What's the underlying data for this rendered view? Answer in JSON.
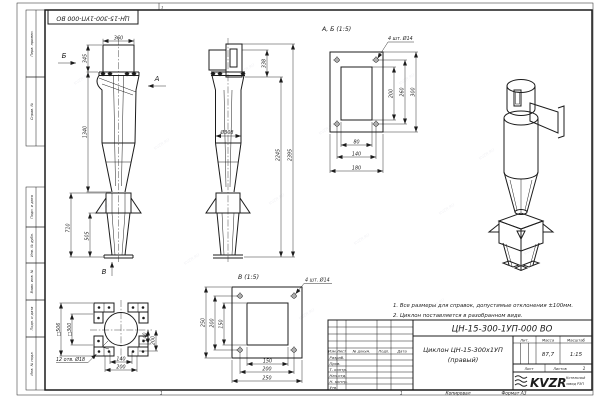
{
  "frame": {
    "stamp": "ЦН-15-300-1УП-000 ВО",
    "side_labels": [
      "Перв. примен.",
      "Справ. №",
      "Подп. и дата",
      "Инв. № дубл.",
      "Взам. инв. №",
      "Подп. и дата",
      "Инв. № подл."
    ],
    "fold_mark": "1",
    "bottom_mark": "1",
    "copied": "Копировал",
    "format": "Формат А3"
  },
  "watermark": {
    "text": "KVZR.RU"
  },
  "notes": {
    "line1": "1. Все размеры для справок, допустимые отклонения ±100мм.",
    "line2": "2. Циклон поставляется в разобранном виде."
  },
  "views": {
    "front": {
      "d360": "360",
      "d345": "345",
      "d1340": "1340",
      "d710": "710",
      "d505": "505",
      "arrow_a": "А",
      "arrow_b": "Б",
      "arrow_v": "В"
    },
    "side": {
      "d338": "338",
      "d308": "Ø308",
      "d2245": "2245",
      "d2395": "2395"
    },
    "section_ab": {
      "label": "А, Б (1:5)",
      "holes": "4 шт. Ø14",
      "d200": "200",
      "d260": "260",
      "d300": "300",
      "d80": "80",
      "d140": "140",
      "d180": "180"
    },
    "bottom": {
      "sq506": "□506",
      "sq300": "□300",
      "holes": "12 отв. Ø18",
      "d140v": "140",
      "d200v": "200",
      "d140h": "140",
      "d200h": "200"
    },
    "section_v": {
      "label": "В (1:5)",
      "holes": "4 шт. Ø14",
      "d250l": "250",
      "d200l": "200",
      "d150l": "150",
      "d150b": "150",
      "d200b": "200",
      "d250b": "250"
    }
  },
  "title_block": {
    "doc_number": "ЦН-15-300-1УП-000 ВО",
    "name_line1": "Циклон ЦН-15-300х1УП",
    "name_line2": "(правый)",
    "col_izm": "Изм.",
    "col_list": "Лист",
    "col_docnum": "№ докум.",
    "col_podp": "Подп.",
    "col_data": "Дата",
    "rows": [
      "Разраб.",
      "Пров.",
      "Т. контр.",
      "Нач.отд.",
      "Н. контр.",
      "Утв."
    ],
    "lit_label": "Лит.",
    "mass_label": "Масса",
    "scale_label": "Масштаб",
    "mass_value": "87,7",
    "scale_value": "1:15",
    "sheet_label": "Лист",
    "sheets_label": "Листов",
    "sheets_value": "1",
    "logo": "KVZR",
    "company1": "Котельный",
    "company2": "завод РЭП"
  }
}
